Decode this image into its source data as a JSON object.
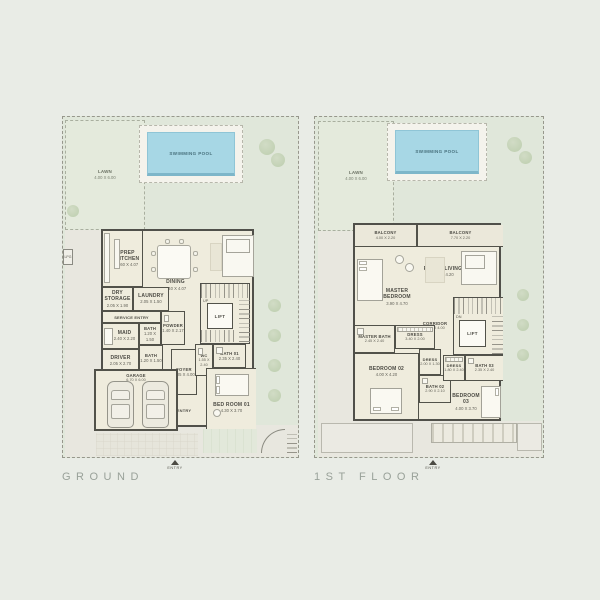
{
  "ground": {
    "title": "GROUND",
    "lawn": {
      "name": "LAWN",
      "dims": "4.00 X 6.00"
    },
    "pool": {
      "name": "SWIMMING POOL"
    },
    "lpg": {
      "name": "LPG"
    },
    "prep_kitchen": {
      "name": "PREP KITCHEN",
      "dims": "2.60 X 4.07"
    },
    "dining": {
      "name": "DINING",
      "dims": "3.40 X 4.07"
    },
    "living": {
      "name": "LIVING",
      "dims": "3.80 X 4.07"
    },
    "dry_storage": {
      "name": "DRY STORAGE",
      "dims": "2.05 X 1.90"
    },
    "laundry": {
      "name": "LAUNDRY",
      "dims": "2.05 X 1.50"
    },
    "service_entry": {
      "name": "SERVICE ENTRY",
      "dims": "0.75 X 1.30"
    },
    "maid": {
      "name": "MAID",
      "dims": "2.40 X 2.20"
    },
    "bath_maid": {
      "name": "BATH",
      "dims": "1.20 X 1.50"
    },
    "powder": {
      "name": "POWDER",
      "dims": "1.40 X 2.17"
    },
    "stairs_note": "UP",
    "lift": "LIFT",
    "driver": {
      "name": "DRIVER",
      "dims": "2.05 X 2.70"
    },
    "bath_driver": {
      "name": "BATH",
      "dims": "1.20 X 1.50"
    },
    "garage": {
      "name": "GARAGE",
      "dims": "6.70 X 6.00"
    },
    "foyer": {
      "name": "FOYER",
      "dims": "2.05 X 4.00"
    },
    "entry_room": "ENTRY",
    "wc": {
      "name": "WC",
      "dims": "1.55 X 2.40"
    },
    "bath01": {
      "name": "BATH 01",
      "dims": "2.35 X 2.40"
    },
    "bedroom01": {
      "name": "BED ROOM 01",
      "dims": "4.30 X 3.70"
    },
    "entry_marker": "ENTRY"
  },
  "first": {
    "title": "1ST FLOOR",
    "lawn": {
      "name": "LAWN",
      "dims": "4.00 X 6.00"
    },
    "pool": {
      "name": "SWIMMING POOL"
    },
    "balcony_left": {
      "name": "BALCONY",
      "dims": "4.00 X 2.20"
    },
    "balcony_right": {
      "name": "BALCONY",
      "dims": "7.70 X 2.20"
    },
    "master_bedroom": {
      "name": "MASTER BEDROOM",
      "dims": "3.90 X 4.70"
    },
    "family_living": {
      "name": "FAMILY LIVING",
      "dims": "4.00 X 4.20"
    },
    "corridor": {
      "name": "CORRIDOR",
      "dims": "2.40 X 4.00"
    },
    "stairs_note": "DN",
    "lift": "LIFT",
    "master_bath": {
      "name": "MASTER BATH",
      "dims": "2.45 X 2.40"
    },
    "dress_master": {
      "name": "DRESS",
      "dims": "3.40 X 2.00"
    },
    "bedroom02": {
      "name": "BEDROOM 02",
      "dims": "4.00 X 4.20"
    },
    "dress02": {
      "name": "DRESS",
      "dims": "2.00 X 1.30"
    },
    "bath02": {
      "name": "BATH 02",
      "dims": "2.90 X 2.10"
    },
    "dress03": {
      "name": "DRESS",
      "dims": "1.80 X 2.40"
    },
    "bath03": {
      "name": "BATH 03",
      "dims": "2.35 X 2.40"
    },
    "bedroom03": {
      "name": "BEDROOM 03",
      "dims": "4.00 X 3.70"
    },
    "entry_marker": "ENTRY"
  }
}
